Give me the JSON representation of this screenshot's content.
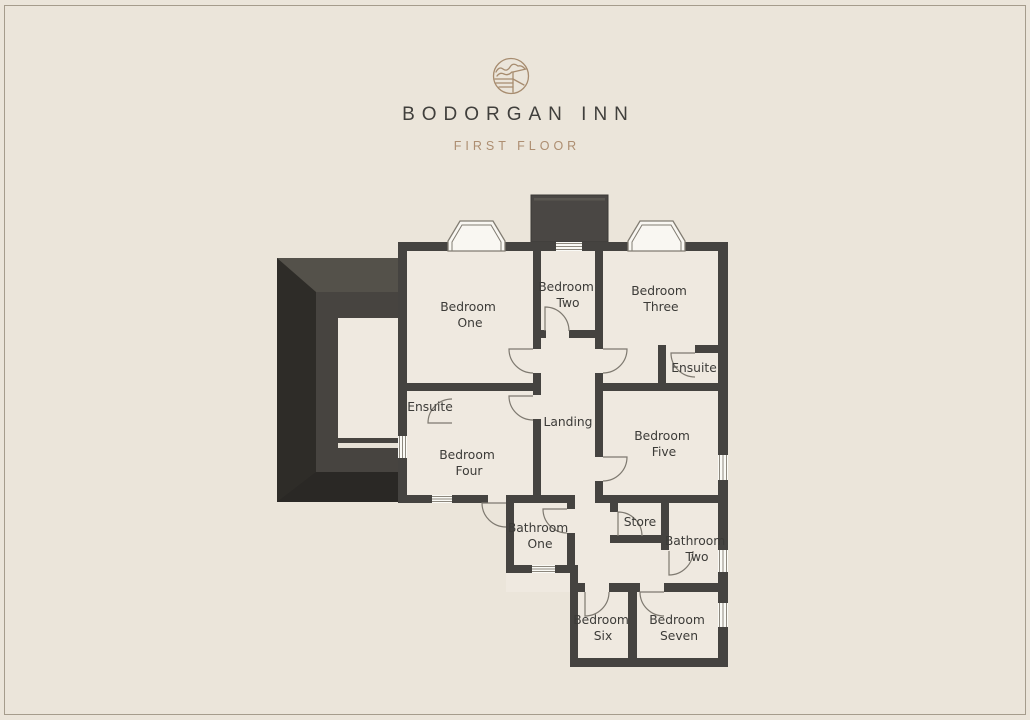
{
  "header": {
    "logo_icon": "hills-and-fields-crest-icon",
    "title": "BODORGAN INN",
    "subtitle": "FIRST FLOOR"
  },
  "palette": {
    "background": "#ebe5da",
    "room_fill": "#efe9e0",
    "wall": "#454340",
    "roof_dark": "#2e2c28",
    "roof_medium": "#54514a",
    "accent_brown": "#ad8e71",
    "title_text": "#403f3c",
    "label_text": "#3c3b38"
  },
  "floorplan": {
    "rooms": [
      {
        "id": "bedroom-one",
        "name": "Bedroom One",
        "lines": [
          "Bedroom",
          "One"
        ]
      },
      {
        "id": "bedroom-two",
        "name": "Bedroom Two",
        "lines": [
          "Bedroom",
          "Two"
        ]
      },
      {
        "id": "bedroom-three",
        "name": "Bedroom Three",
        "lines": [
          "Bedroom",
          "Three"
        ]
      },
      {
        "id": "ensuite-bedroom-three",
        "name": "Ensuite",
        "lines": [
          "Ensuite"
        ]
      },
      {
        "id": "landing",
        "name": "Landing",
        "lines": [
          "Landing"
        ]
      },
      {
        "id": "bedroom-five",
        "name": "Bedroom Five",
        "lines": [
          "Bedroom",
          "Five"
        ]
      },
      {
        "id": "ensuite-bedroom-four",
        "name": "Ensuite",
        "lines": [
          "Ensuite"
        ]
      },
      {
        "id": "bedroom-four",
        "name": "Bedroom Four",
        "lines": [
          "Bedroom",
          "Four"
        ]
      },
      {
        "id": "bathroom-one",
        "name": "Bathroom One",
        "lines": [
          "Bathroom",
          "One"
        ]
      },
      {
        "id": "store",
        "name": "Store",
        "lines": [
          "Store"
        ]
      },
      {
        "id": "bathroom-two",
        "name": "Bathroom Two",
        "lines": [
          "Bathroom",
          "Two"
        ]
      },
      {
        "id": "bedroom-six",
        "name": "Bedroom Six",
        "lines": [
          "Bedroom",
          "Six"
        ]
      },
      {
        "id": "bedroom-seven",
        "name": "Bedroom Seven",
        "lines": [
          "Bedroom",
          "Seven"
        ]
      }
    ]
  }
}
